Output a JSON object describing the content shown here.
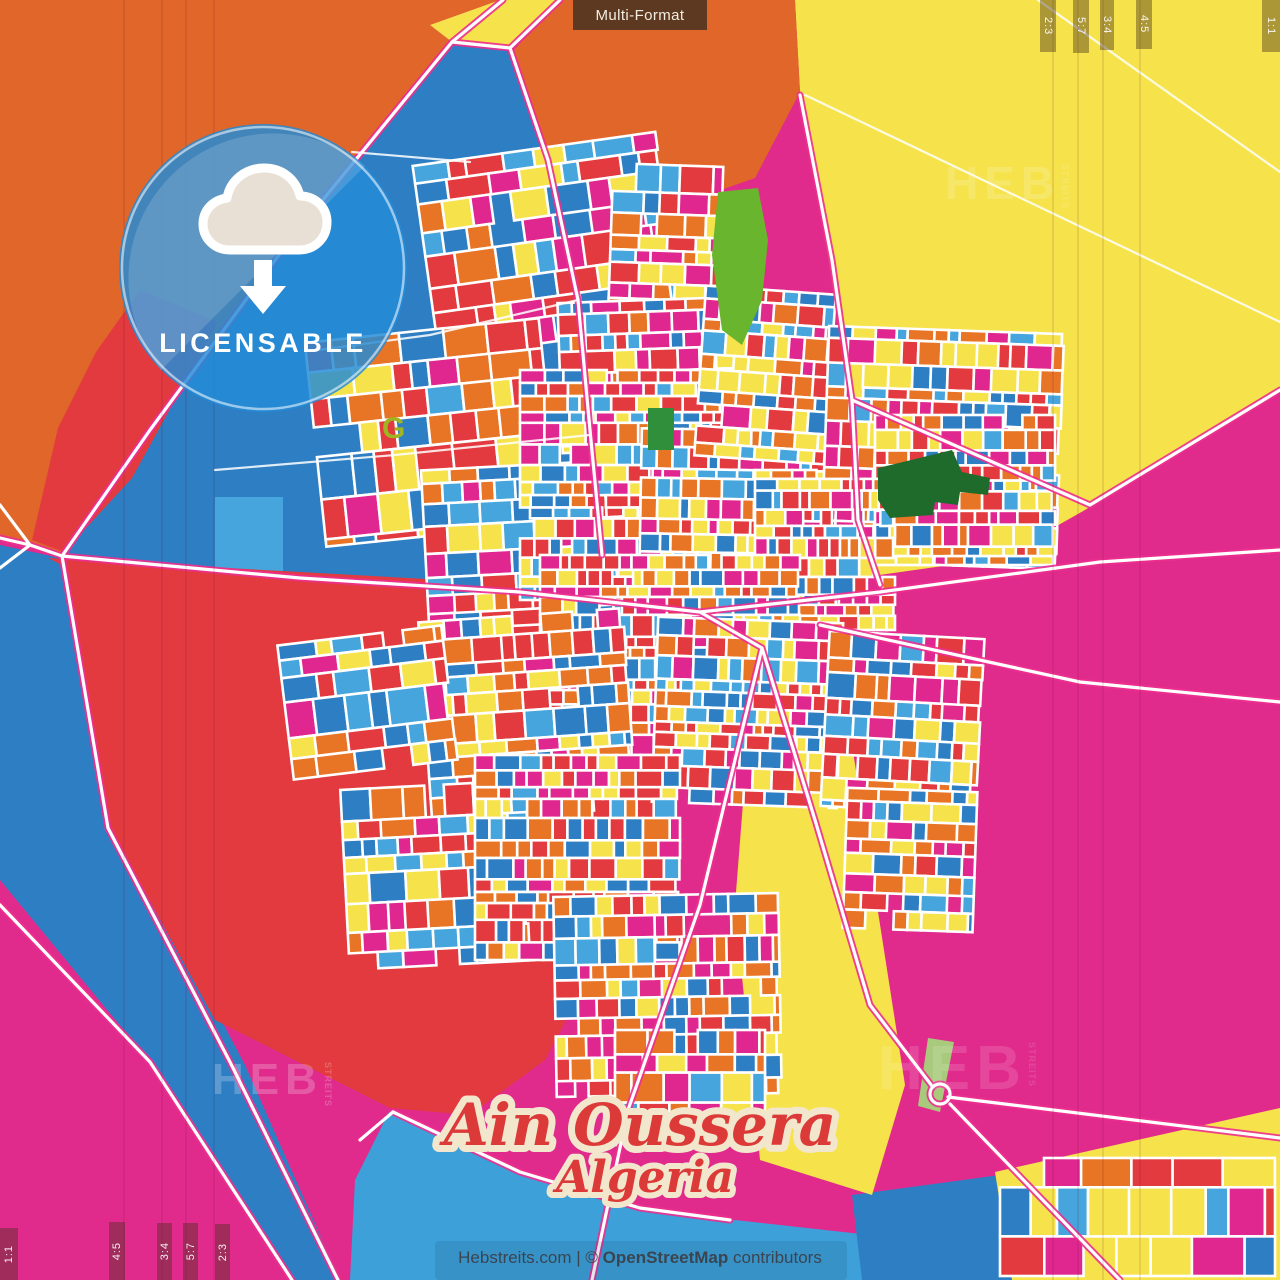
{
  "header": {
    "format_label": "Multi-Format"
  },
  "crop_marks": {
    "top_right": [
      "2:3",
      "5:7",
      "3:4",
      "4:5"
    ],
    "top_right_corner": "1:1",
    "bottom_left": [
      "4:5",
      "3:4",
      "5:7",
      "2:3"
    ],
    "bottom_left_corner": "1:1"
  },
  "badge": {
    "label": "LICENSABLE",
    "icon": "cloud-download"
  },
  "title": {
    "city": "Ain Oussera",
    "country": "Algeria"
  },
  "watermark": {
    "text": "HEB",
    "sub": "STREITS"
  },
  "attribution": {
    "prefix": "Hebstreits.com | © ",
    "osm": "OpenStreetMap",
    "suffix": " contributors"
  },
  "map": {
    "colors": {
      "magenta": "#e02b8c",
      "red": "#e23a3e",
      "orange": "#e0662a",
      "orange_block": "#e87425",
      "yellow": "#f6e34c",
      "blue": "#2e7ec4",
      "light_blue": "#45a5dc",
      "pale_blue_bottom": "#3da0d8",
      "green_bright": "#69b52d",
      "green_dark": "#1f6b2c",
      "green_pale": "#a9c97c",
      "olive_glyph": "#9fb421",
      "road_fill": "#ffffff",
      "road_casing": "#ed2f8f",
      "badge_blue": "#248cd7",
      "title_red": "#dc3a38",
      "title_outline": "#f2e7cc"
    },
    "seed": 1234,
    "palette": [
      "#e23a3e",
      "#e87425",
      "#f6e34c",
      "#e0268f",
      "#2e7ec4",
      "#45a5dc"
    ],
    "weights": [
      0.21,
      0.2,
      0.17,
      0.16,
      0.16,
      0.1
    ],
    "districts": [
      {
        "x": 425,
        "y": 148,
        "w": 245,
        "h": 195,
        "s": 27,
        "r": -8
      },
      {
        "x": 610,
        "y": 165,
        "w": 110,
        "h": 190,
        "s": 21,
        "r": 2
      },
      {
        "x": 560,
        "y": 300,
        "w": 180,
        "h": 150,
        "s": 19,
        "r": -2
      },
      {
        "x": 315,
        "y": 330,
        "w": 235,
        "h": 205,
        "s": 29,
        "r": -6
      },
      {
        "x": 425,
        "y": 465,
        "w": 205,
        "h": 160,
        "s": 22,
        "r": -3
      },
      {
        "x": 520,
        "y": 370,
        "w": 250,
        "h": 230,
        "s": 16,
        "r": 0
      },
      {
        "x": 640,
        "y": 430,
        "w": 200,
        "h": 210,
        "s": 15,
        "r": 1
      },
      {
        "x": 700,
        "y": 290,
        "w": 130,
        "h": 170,
        "s": 18,
        "r": 4
      },
      {
        "x": 825,
        "y": 330,
        "w": 235,
        "h": 235,
        "s": 18,
        "r": 2
      },
      {
        "x": 875,
        "y": 415,
        "w": 180,
        "h": 150,
        "s": 15,
        "r": 0
      },
      {
        "x": 755,
        "y": 470,
        "w": 140,
        "h": 160,
        "s": 14,
        "r": 0
      },
      {
        "x": 540,
        "y": 555,
        "w": 260,
        "h": 200,
        "s": 15,
        "r": 0
      },
      {
        "x": 655,
        "y": 620,
        "w": 185,
        "h": 185,
        "s": 16,
        "r": 2
      },
      {
        "x": 425,
        "y": 615,
        "w": 205,
        "h": 200,
        "s": 20,
        "r": -4
      },
      {
        "x": 285,
        "y": 635,
        "w": 165,
        "h": 135,
        "s": 25,
        "r": -7
      },
      {
        "x": 345,
        "y": 785,
        "w": 185,
        "h": 185,
        "s": 23,
        "r": -3
      },
      {
        "x": 475,
        "y": 755,
        "w": 205,
        "h": 205,
        "s": 17,
        "r": 0
      },
      {
        "x": 555,
        "y": 895,
        "w": 225,
        "h": 200,
        "s": 18,
        "r": -1
      },
      {
        "x": 615,
        "y": 1030,
        "w": 150,
        "h": 115,
        "s": 21,
        "r": 0
      },
      {
        "x": 825,
        "y": 635,
        "w": 155,
        "h": 175,
        "s": 18,
        "r": 3
      },
      {
        "x": 845,
        "y": 790,
        "w": 130,
        "h": 140,
        "s": 20,
        "r": 2
      },
      {
        "x": 1000,
        "y": 1158,
        "w": 275,
        "h": 118,
        "s": 36,
        "r": 0
      }
    ],
    "crop_lines_x_left": [
      124,
      162,
      186,
      214
    ],
    "crop_lines_x_right": [
      1053,
      1078,
      1103,
      1140
    ]
  }
}
